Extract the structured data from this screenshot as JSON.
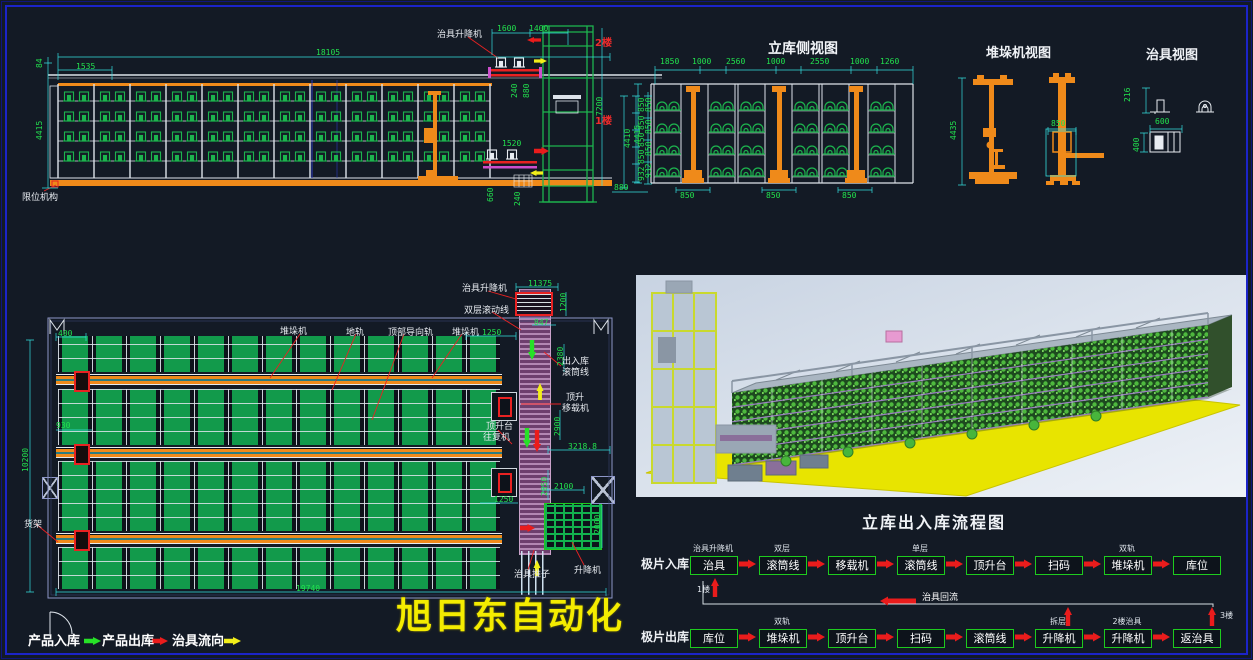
{
  "colors": {
    "bg": "#131a25",
    "frame_blue": "#1c24c8",
    "dim_green": "#22e14e",
    "dim_cyan": "#35dede",
    "rack_green": "#129a4b",
    "rail_orange": "#ef8a1a",
    "alert_red": "#e82222",
    "flow_yellow": "#f2ee1a",
    "conveyor_purple": "#b387b3",
    "watermark_yellow": "#f4ec00"
  },
  "watermark": "旭日东自动化",
  "titles": {
    "side": "立库侧视图",
    "stacker": "堆垛机视图",
    "jig": "治具视图",
    "flow": "立库出入库流程图"
  },
  "legend": {
    "in": "产品入库",
    "out": "产品出库",
    "jig": "治具流向"
  },
  "flow": {
    "in_head": "极片入库",
    "out_head": "极片出库",
    "return_label": "治具回流",
    "in_steps": [
      {
        "b": "治具",
        "a": "治具升降机",
        "below": "1楼"
      },
      {
        "b": "滚筒线",
        "a": "双层"
      },
      {
        "b": "移载机"
      },
      {
        "b": "滚筒线",
        "a": "单层"
      },
      {
        "b": "顶升台"
      },
      {
        "b": "扫码"
      },
      {
        "b": "堆垛机",
        "a": "双轨"
      },
      {
        "b": "库位"
      }
    ],
    "out_steps": [
      {
        "b": "库位"
      },
      {
        "b": "堆垛机",
        "a": "双轨"
      },
      {
        "b": "顶升台"
      },
      {
        "b": "扫码"
      },
      {
        "b": "滚筒线"
      },
      {
        "b": "升降机",
        "a": "拆层",
        "riser": true
      },
      {
        "b": "升降机",
        "a": "2楼治具"
      },
      {
        "b": "返治具",
        "riser": true,
        "riser_label": "3楼"
      }
    ]
  },
  "labels": [
    {
      "t": "治具升降机",
      "x": 437,
      "y": 31
    },
    {
      "t": "限位机构",
      "x": 22,
      "y": 194
    },
    {
      "t": "2楼",
      "x": 595,
      "y": 38,
      "c": "red"
    },
    {
      "t": "1楼",
      "x": 595,
      "y": 116,
      "c": "red"
    },
    {
      "t": "堆垛机",
      "x": 280,
      "y": 328
    },
    {
      "t": "地轨",
      "x": 346,
      "y": 329
    },
    {
      "t": "顶部导向轨",
      "x": 388,
      "y": 329
    },
    {
      "t": "堆垛机",
      "x": 452,
      "y": 329
    },
    {
      "t": "治具升降机",
      "x": 462,
      "y": 285
    },
    {
      "t": "双层滚动线",
      "x": 464,
      "y": 307
    },
    {
      "t": "出入库",
      "x": 562,
      "y": 358
    },
    {
      "t": "滚筒线",
      "x": 562,
      "y": 369
    },
    {
      "t": "顶升",
      "x": 566,
      "y": 394
    },
    {
      "t": "移载机",
      "x": 562,
      "y": 405
    },
    {
      "t": "顶升台",
      "x": 486,
      "y": 423
    },
    {
      "t": "往复机",
      "x": 483,
      "y": 434
    },
    {
      "t": "治具推子",
      "x": 514,
      "y": 571
    },
    {
      "t": "升降机",
      "x": 574,
      "y": 567
    },
    {
      "t": "货架",
      "x": 24,
      "y": 521
    }
  ],
  "dims": [
    {
      "t": "18105",
      "x": 316,
      "y": 49
    },
    {
      "t": "1535",
      "x": 76,
      "y": 63
    },
    {
      "t": "84",
      "x": 36,
      "y": 68,
      "r": 1
    },
    {
      "t": "4415",
      "x": 36,
      "y": 140,
      "r": 1
    },
    {
      "t": "1600",
      "x": 497,
      "y": 25
    },
    {
      "t": "1400",
      "x": 529,
      "y": 25
    },
    {
      "t": "7200",
      "x": 596,
      "y": 116,
      "r": 1
    },
    {
      "t": "240",
      "x": 511,
      "y": 98,
      "r": 1
    },
    {
      "t": "880",
      "x": 523,
      "y": 98,
      "r": 1
    },
    {
      "t": "1520",
      "x": 502,
      "y": 140
    },
    {
      "t": "660",
      "x": 487,
      "y": 202,
      "r": 1
    },
    {
      "t": "240",
      "x": 514,
      "y": 206,
      "r": 1
    },
    {
      "t": "850",
      "x": 638,
      "y": 112,
      "r": 1
    },
    {
      "t": "850",
      "x": 638,
      "y": 130,
      "r": 1
    },
    {
      "t": "850",
      "x": 638,
      "y": 147,
      "r": 1
    },
    {
      "t": "850",
      "x": 638,
      "y": 164,
      "r": 1
    },
    {
      "t": "932",
      "x": 638,
      "y": 181,
      "r": 1
    },
    {
      "t": "4410",
      "x": 624,
      "y": 148,
      "r": 1
    },
    {
      "t": "880",
      "x": 614,
      "y": 184
    },
    {
      "t": "1850",
      "x": 660,
      "y": 58
    },
    {
      "t": "1000",
      "x": 692,
      "y": 58
    },
    {
      "t": "2560",
      "x": 726,
      "y": 58
    },
    {
      "t": "1000",
      "x": 766,
      "y": 58
    },
    {
      "t": "2550",
      "x": 810,
      "y": 58
    },
    {
      "t": "1000",
      "x": 850,
      "y": 58
    },
    {
      "t": "1260",
      "x": 880,
      "y": 58
    },
    {
      "t": "850",
      "x": 645,
      "y": 112,
      "r": 1
    },
    {
      "t": "850",
      "x": 645,
      "y": 134,
      "r": 1
    },
    {
      "t": "850",
      "x": 645,
      "y": 156,
      "r": 1
    },
    {
      "t": "932",
      "x": 645,
      "y": 178,
      "r": 1
    },
    {
      "t": "4415",
      "x": 634,
      "y": 144,
      "r": 1
    },
    {
      "t": "850",
      "x": 680,
      "y": 192
    },
    {
      "t": "850",
      "x": 766,
      "y": 192
    },
    {
      "t": "850",
      "x": 842,
      "y": 192
    },
    {
      "t": "4435",
      "x": 950,
      "y": 140,
      "r": 1
    },
    {
      "t": "850",
      "x": 1051,
      "y": 120
    },
    {
      "t": "216",
      "x": 1124,
      "y": 102,
      "r": 1
    },
    {
      "t": "600",
      "x": 1155,
      "y": 118
    },
    {
      "t": "400",
      "x": 1133,
      "y": 152,
      "r": 1
    },
    {
      "t": "11375",
      "x": 528,
      "y": 280
    },
    {
      "t": "1200",
      "x": 560,
      "y": 312,
      "r": 1
    },
    {
      "t": "847",
      "x": 534,
      "y": 319
    },
    {
      "t": "1250",
      "x": 482,
      "y": 329
    },
    {
      "t": "2380",
      "x": 557,
      "y": 366,
      "r": 1
    },
    {
      "t": "2900",
      "x": 554,
      "y": 436,
      "r": 1
    },
    {
      "t": "3218.8",
      "x": 568,
      "y": 443
    },
    {
      "t": "2850",
      "x": 541,
      "y": 496,
      "r": 1
    },
    {
      "t": "2100",
      "x": 554,
      "y": 483
    },
    {
      "t": "2000",
      "x": 594,
      "y": 534,
      "r": 1
    },
    {
      "t": "1250",
      "x": 494,
      "y": 496
    },
    {
      "t": "400",
      "x": 58,
      "y": 330
    },
    {
      "t": "930",
      "x": 56,
      "y": 422
    },
    {
      "t": "10200",
      "x": 22,
      "y": 472,
      "r": 1
    },
    {
      "t": "19740",
      "x": 296,
      "y": 585
    }
  ]
}
